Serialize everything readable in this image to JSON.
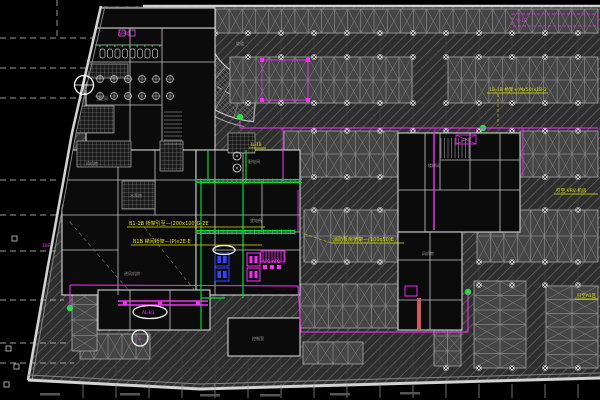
{
  "scene": {
    "width": 600,
    "height": 400,
    "kind": "cad-basement-garage-electrical-plan"
  },
  "colors": {
    "bg": "#000000",
    "floor": "#2e2e2e",
    "hatch": "#565656",
    "hatch2": "#666666",
    "stall_fill": "#454545",
    "stall_line": "#a8a8a8",
    "stall_x": "#8d8d8d",
    "wall": "#d2d2d2",
    "wall_dim": "#868686",
    "room_fill": "#0b0b0b",
    "inner_wall": "#c6c6c6",
    "grid": "#454545",
    "grid_h": "#3d3d3d",
    "dash_white": "#cfcfcf",
    "tick": "#9a9a9a",
    "green": "#00dd33",
    "green_dot": "#22e544",
    "magenta": "#ff2bff",
    "magenta_soft": "#d060d0",
    "blue": "#3344ff",
    "yellow": "#e3e300",
    "white": "#ffffff",
    "tile": "#8f8f8f",
    "red_strip": "#cc5a5a",
    "marker": "#dcdcdc",
    "label_gray": "#9a9a9a",
    "smudge": "#555555"
  },
  "boundary": {
    "floor": [
      [
        101,
        6
      ],
      [
        600,
        6
      ],
      [
        600,
        378
      ],
      [
        200,
        389
      ],
      [
        28,
        380
      ]
    ],
    "left_wall": [
      [
        101,
        6
      ],
      [
        72,
        133
      ],
      [
        48,
        266
      ],
      [
        28,
        380
      ]
    ],
    "top_wall": [
      [
        143,
        6
      ],
      [
        600,
        6
      ]
    ],
    "bottom_wall": [
      [
        28,
        380
      ],
      [
        200,
        389
      ],
      [
        600,
        378
      ]
    ]
  },
  "grid": {
    "xs": [
      83,
      116,
      149,
      182,
      215,
      248,
      281,
      314,
      347,
      380,
      413,
      446,
      479,
      512,
      545,
      578
    ],
    "ys": [
      33,
      57,
      103,
      131,
      177,
      210,
      262,
      285,
      333,
      368
    ]
  },
  "dashed_lines": [
    [
      0,
      38,
      94,
      38
    ],
    [
      0,
      68,
      88,
      68
    ],
    [
      0,
      98,
      82,
      98
    ],
    [
      57,
      0,
      57,
      38
    ],
    [
      0,
      180,
      58,
      180
    ],
    [
      0,
      215,
      58,
      215
    ],
    [
      0,
      251,
      58,
      251
    ],
    [
      0,
      300,
      64,
      300
    ],
    [
      0,
      343,
      70,
      343
    ],
    [
      0,
      363,
      74,
      363
    ]
  ],
  "edge_markers": [
    [
      12,
      236
    ],
    [
      6,
      346
    ],
    [
      14,
      364
    ],
    [
      4,
      382
    ]
  ],
  "ramp": {
    "cx": 262,
    "cy": 25,
    "r_outer": 97,
    "r_inner": 55,
    "r_mid": 76,
    "r_rim": 103,
    "a0": 95,
    "a1": 185,
    "radial_step": 12
  },
  "parking_bands": [
    {
      "x": 150,
      "y": 9,
      "w": 448,
      "h": 24,
      "rows": 1,
      "o": "h"
    },
    {
      "x": 230,
      "y": 57,
      "w": 182,
      "h": 46,
      "rows": 2,
      "o": "h"
    },
    {
      "x": 448,
      "y": 57,
      "w": 150,
      "h": 46,
      "rows": 2,
      "o": "h"
    },
    {
      "x": 284,
      "y": 131,
      "w": 114,
      "h": 46,
      "rows": 2,
      "o": "h"
    },
    {
      "x": 520,
      "y": 131,
      "w": 78,
      "h": 46,
      "rows": 2,
      "o": "h"
    },
    {
      "x": 304,
      "y": 210,
      "w": 94,
      "h": 52,
      "rows": 2,
      "o": "h"
    },
    {
      "x": 477,
      "y": 210,
      "w": 121,
      "h": 52,
      "rows": 2,
      "o": "h"
    },
    {
      "x": 300,
      "y": 284,
      "w": 100,
      "h": 44,
      "rows": 2,
      "o": "h"
    },
    {
      "x": 303,
      "y": 342,
      "w": 60,
      "h": 22,
      "rows": 1,
      "o": "h"
    },
    {
      "x": 80,
      "y": 334,
      "w": 70,
      "h": 25,
      "rows": 1,
      "o": "h"
    },
    {
      "x": 72,
      "y": 289,
      "w": 25,
      "h": 62,
      "cols": 1,
      "o": "v"
    },
    {
      "x": 434,
      "y": 276,
      "w": 27,
      "h": 90,
      "cols": 2,
      "o": "v"
    },
    {
      "x": 474,
      "y": 281,
      "w": 52,
      "h": 87,
      "cols": 2,
      "o": "v"
    },
    {
      "x": 546,
      "y": 286,
      "w": 52,
      "h": 82,
      "cols": 2,
      "o": "v"
    },
    {
      "x": 237,
      "y": 318,
      "w": 34,
      "h": 34,
      "cols": 2,
      "o": "v"
    }
  ],
  "marker_rows": [
    {
      "y": 33,
      "x0": 150,
      "x1": 598
    },
    {
      "y": 57,
      "x0": 230,
      "x1": 598
    },
    {
      "y": 103,
      "x0": 230,
      "x1": 598
    },
    {
      "y": 131,
      "x0": 284,
      "x1": 598
    },
    {
      "y": 177,
      "x0": 284,
      "x1": 598
    },
    {
      "y": 210,
      "x0": 304,
      "x1": 598
    },
    {
      "y": 262,
      "x0": 304,
      "x1": 598
    },
    {
      "y": 285,
      "x0": 434,
      "x1": 598
    },
    {
      "y": 368,
      "x0": 434,
      "x1": 598
    }
  ],
  "rooms": {
    "blocks": [
      [
        86,
        28,
        129,
        122
      ],
      [
        95,
        8,
        120,
        20
      ],
      [
        62,
        150,
        134,
        145
      ],
      [
        196,
        150,
        104,
        145
      ],
      [
        398,
        133,
        122,
        99
      ],
      [
        398,
        232,
        64,
        98
      ],
      [
        228,
        318,
        72,
        38
      ],
      [
        98,
        290,
        112,
        40
      ]
    ],
    "walls": [
      [
        130,
        28,
        130,
        150
      ],
      [
        162,
        28,
        162,
        150
      ],
      [
        86,
        62,
        215,
        62
      ],
      [
        86,
        105,
        162,
        105
      ],
      [
        95,
        45,
        162,
        45
      ],
      [
        118,
        150,
        118,
        295
      ],
      [
        155,
        150,
        155,
        215
      ],
      [
        62,
        180,
        196,
        180
      ],
      [
        62,
        215,
        215,
        215
      ],
      [
        62,
        250,
        118,
        250
      ],
      [
        196,
        181,
        300,
        181
      ],
      [
        215,
        215,
        300,
        215
      ],
      [
        196,
        232,
        300,
        232
      ],
      [
        215,
        250,
        300,
        250
      ],
      [
        215,
        150,
        215,
        295
      ],
      [
        243,
        150,
        243,
        181
      ],
      [
        262,
        181,
        262,
        232
      ],
      [
        283,
        150,
        283,
        181
      ],
      [
        425,
        133,
        425,
        232
      ],
      [
        440,
        133,
        440,
        190
      ],
      [
        470,
        133,
        470,
        190
      ],
      [
        500,
        133,
        500,
        232
      ],
      [
        440,
        160,
        520,
        160
      ],
      [
        398,
        190,
        520,
        190
      ],
      [
        398,
        260,
        462,
        260
      ],
      [
        398,
        300,
        462,
        300
      ],
      [
        430,
        232,
        430,
        330
      ],
      [
        130,
        290,
        130,
        330
      ],
      [
        170,
        290,
        170,
        330
      ]
    ],
    "tiled": [
      [
        88,
        64,
        40,
        14
      ],
      [
        76,
        106,
        38,
        27
      ],
      [
        77,
        141,
        54,
        26
      ],
      [
        160,
        141,
        23,
        30
      ],
      [
        122,
        181,
        33,
        28
      ],
      [
        228,
        133,
        27,
        20
      ]
    ],
    "stairs": [
      [
        441,
        138,
        28,
        20,
        "v"
      ],
      [
        164,
        112,
        18,
        34,
        "h"
      ]
    ],
    "open_dashes": [
      [
        70,
        222,
        130,
        292
      ],
      [
        140,
        222,
        196,
        292
      ]
    ]
  },
  "fixtures": {
    "urinals": {
      "x0": 100,
      "y": 49,
      "n": 8,
      "dx": 7.5,
      "w": 5,
      "h": 9
    },
    "lights": {
      "xs": [
        100,
        114,
        128,
        142,
        156,
        170
      ],
      "ys": [
        79,
        96
      ],
      "r": 3.4
    },
    "pumps": [
      [
        237,
        156
      ],
      [
        237,
        168
      ]
    ]
  },
  "equipment": {
    "blue_boxes": [
      [
        215,
        253,
        14,
        13
      ],
      [
        215,
        268,
        14,
        13
      ]
    ],
    "magenta_boxes": [
      [
        247,
        253,
        13,
        13
      ],
      [
        247,
        268,
        13,
        13
      ]
    ],
    "magenta_hatch_block": [
      261,
      251,
      24,
      11
    ],
    "magenta_small_squares": [
      [
        263,
        265
      ],
      [
        270,
        265
      ],
      [
        277,
        265
      ]
    ],
    "elevator_box": [
      456,
      135,
      20,
      9
    ],
    "red_strip": [
      417,
      298,
      4,
      32
    ],
    "magenta_box2": [
      405,
      286,
      12,
      10
    ],
    "magenta_top_squares": [
      [
        119,
        30
      ],
      [
        129,
        30
      ]
    ]
  },
  "green": {
    "trays": [
      [
        196,
        181,
        302,
        181
      ],
      [
        196,
        232,
        295,
        232
      ]
    ],
    "lines": [
      [
        201,
        181,
        201,
        330
      ],
      [
        243,
        181,
        243,
        298
      ],
      [
        208,
        150,
        208,
        181
      ],
      [
        201,
        298,
        225,
        298
      ],
      [
        246,
        150,
        246,
        181
      ]
    ],
    "dots": [
      [
        240,
        117
      ],
      [
        70,
        308
      ],
      [
        468,
        292
      ],
      [
        483,
        128
      ]
    ],
    "tick_row": {
      "x0": 99,
      "y": 45,
      "n": 9,
      "dx": 7.5
    }
  },
  "magenta_routes": {
    "lines": [
      {
        "pts": [
          [
            240,
            121
          ],
          [
            240,
            128
          ],
          [
            598,
            128
          ]
        ],
        "w": 1
      },
      {
        "pts": [
          [
            283,
            128
          ],
          [
            283,
            178
          ]
        ],
        "w": 0.8
      },
      {
        "pts": [
          [
            298,
            190
          ],
          [
            298,
            232
          ]
        ],
        "w": 0.8
      },
      {
        "pts": [
          [
            70,
            285
          ],
          [
            298,
            286
          ],
          [
            301,
            332
          ],
          [
            468,
            332
          ],
          [
            468,
            292
          ]
        ],
        "w": 1
      },
      {
        "pts": [
          [
            70,
            285
          ],
          [
            70,
            308
          ]
        ],
        "w": 1
      },
      {
        "pts": [
          [
            118,
            301
          ],
          [
            208,
            301
          ]
        ],
        "w": 1.6
      },
      {
        "pts": [
          [
            118,
            305
          ],
          [
            208,
            305
          ]
        ],
        "w": 1.6
      },
      {
        "pts": [
          [
            434,
            133
          ],
          [
            434,
            230
          ]
        ],
        "w": 1.4
      },
      {
        "pts": [
          [
            523,
            128
          ],
          [
            523,
            176
          ]
        ],
        "w": 0.8
      },
      {
        "pts": [
          [
            435,
            128
          ],
          [
            435,
            133
          ]
        ],
        "w": 0.8
      }
    ],
    "loop": {
      "pts": [
        [
          262,
          60
        ],
        [
          308,
          60
        ],
        [
          308,
          100
        ],
        [
          262,
          100
        ],
        [
          262,
          60
        ]
      ],
      "w": 0.7
    },
    "nodes": [
      [
        262,
        60
      ],
      [
        308,
        60
      ],
      [
        262,
        100
      ],
      [
        308,
        100
      ],
      [
        125,
        303
      ],
      [
        160,
        303
      ],
      [
        198,
        303
      ]
    ],
    "dashed_box": [
      512,
      14,
      86,
      12
    ]
  },
  "highlights": [
    {
      "type": "ellipse",
      "cx": 150,
      "cy": 312,
      "rx": 17,
      "ry": 6.5
    },
    {
      "type": "circle",
      "cx": 140,
      "cy": 338,
      "r": 8
    },
    {
      "type": "ellipse",
      "cx": 224,
      "cy": 250,
      "rx": 11,
      "ry": 4.5
    },
    {
      "type": "circle",
      "cx": 84,
      "cy": 85,
      "r": 9.5,
      "cross": true
    }
  ],
  "annotations": [
    {
      "x": 129,
      "y": 225,
      "size": 5,
      "text": "B1-1B 桥架引至—(200x100)G-2E",
      "ux1": 127,
      "ux2": 265,
      "uy": 227
    },
    {
      "x": 133,
      "y": 243,
      "size": 5,
      "text": "B1B 梯间桥架—(P)x2E-E",
      "ux1": 131,
      "ux2": 262,
      "uy": 245
    },
    {
      "x": 489,
      "y": 91,
      "size": 4.6,
      "text": "1B-1B 桥架+(Mx50)x1B-2",
      "ux1": 487,
      "ux2": 548,
      "uy": 93
    },
    {
      "x": 333,
      "y": 241,
      "size": 5,
      "text": "消防泵房桥架—(100x50)E",
      "ux1": 331,
      "ux2": 404,
      "uy": 243
    },
    {
      "x": 556,
      "y": 192,
      "size": 4.6,
      "text": "引至 VRV 机房",
      "ux1": 554,
      "ux2": 598,
      "uy": 194
    },
    {
      "x": 577,
      "y": 297,
      "size": 4.4,
      "text": "引至A1区",
      "ux1": 575,
      "ux2": 598,
      "uy": 299
    },
    {
      "x": 250,
      "y": 146,
      "size": 4,
      "text": "1L-1B",
      "ux1": 249,
      "ux2": 266,
      "uy": 148
    }
  ],
  "annotation_leads": [
    [
      498,
      94,
      498,
      126
    ],
    [
      331,
      243,
      302,
      233
    ]
  ],
  "labels": {
    "magenta": [
      {
        "x": 142,
        "y": 314,
        "text": "AL-B1"
      },
      {
        "x": 138.5,
        "y": 340,
        "text": "1"
      },
      {
        "x": 42,
        "y": 247,
        "text": "1BF"
      },
      {
        "x": 262,
        "y": 263,
        "text": "AP1 AP2"
      },
      {
        "x": 118,
        "y": 35,
        "text": "AP-B1"
      },
      {
        "x": 516,
        "y": 22,
        "text": "YJ-1B"
      }
    ],
    "rooms": [
      {
        "x": 96,
        "y": 100,
        "text": "卫生间"
      },
      {
        "x": 86,
        "y": 165,
        "text": "风机房"
      },
      {
        "x": 130,
        "y": 197,
        "text": "水泵房"
      },
      {
        "x": 248,
        "y": 163,
        "text": "配电间"
      },
      {
        "x": 250,
        "y": 222,
        "text": "变电所"
      },
      {
        "x": 124,
        "y": 275,
        "text": "进风机房"
      },
      {
        "x": 428,
        "y": 167,
        "text": "楼梯间"
      },
      {
        "x": 422,
        "y": 255,
        "text": "风机房"
      },
      {
        "x": 252,
        "y": 340,
        "text": "控制室"
      },
      {
        "x": 236,
        "y": 45,
        "text": "坡道"
      }
    ]
  },
  "dim_smudges": [
    [
      40,
      393
    ],
    [
      120,
      393
    ],
    [
      200,
      394
    ],
    [
      260,
      394
    ],
    [
      330,
      393
    ],
    [
      400,
      392
    ]
  ]
}
